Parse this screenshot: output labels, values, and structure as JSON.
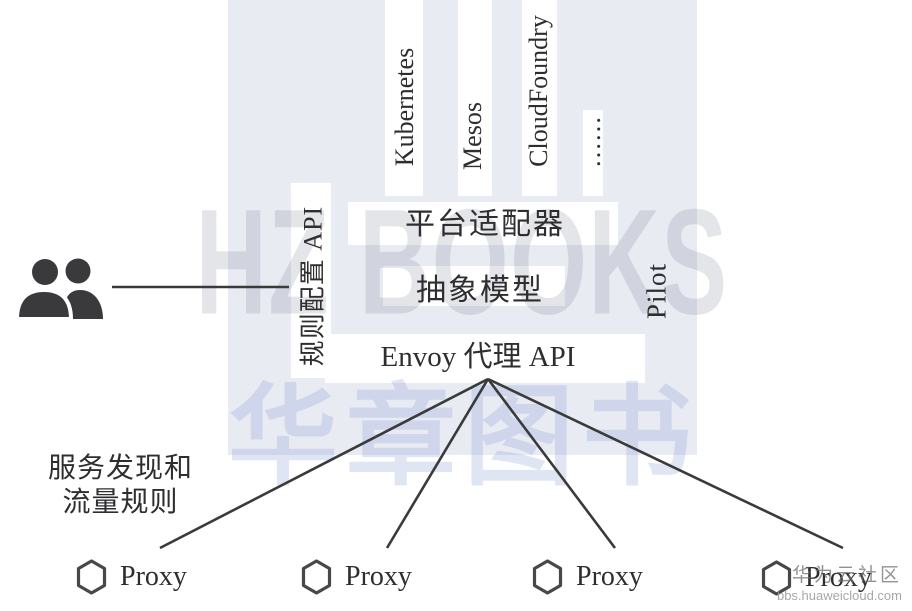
{
  "diagram": {
    "platforms": [
      "Kubernetes",
      "Mesos",
      "CloudFoundry",
      "……"
    ],
    "platform_adapter": "平台适配器",
    "abstract_model": "抽象模型",
    "envoy_api": "Envoy 代理 API",
    "pilot": "Pilot",
    "rule_config_api": "规则配置 API",
    "discovery_line1": "服务发现和",
    "discovery_line2": "流量规则",
    "proxies": [
      "Proxy",
      "Proxy",
      "Proxy",
      "Proxy"
    ],
    "icons": {
      "left_actor": "people-icon",
      "proxy_marker": "hexagon-icon"
    }
  },
  "watermarks": {
    "publisher_en": "HZ BOOKS",
    "publisher_cn": "华章图书",
    "community": "华为云社区",
    "community_url": "bbs.huaweicloud.com"
  },
  "colors": {
    "panel_background": "#e9ebf3",
    "text": "#2e2e30",
    "connector": "#3a3a3a",
    "icon_fill": "#3a3a3c",
    "hexagon_stroke": "#48484c"
  }
}
